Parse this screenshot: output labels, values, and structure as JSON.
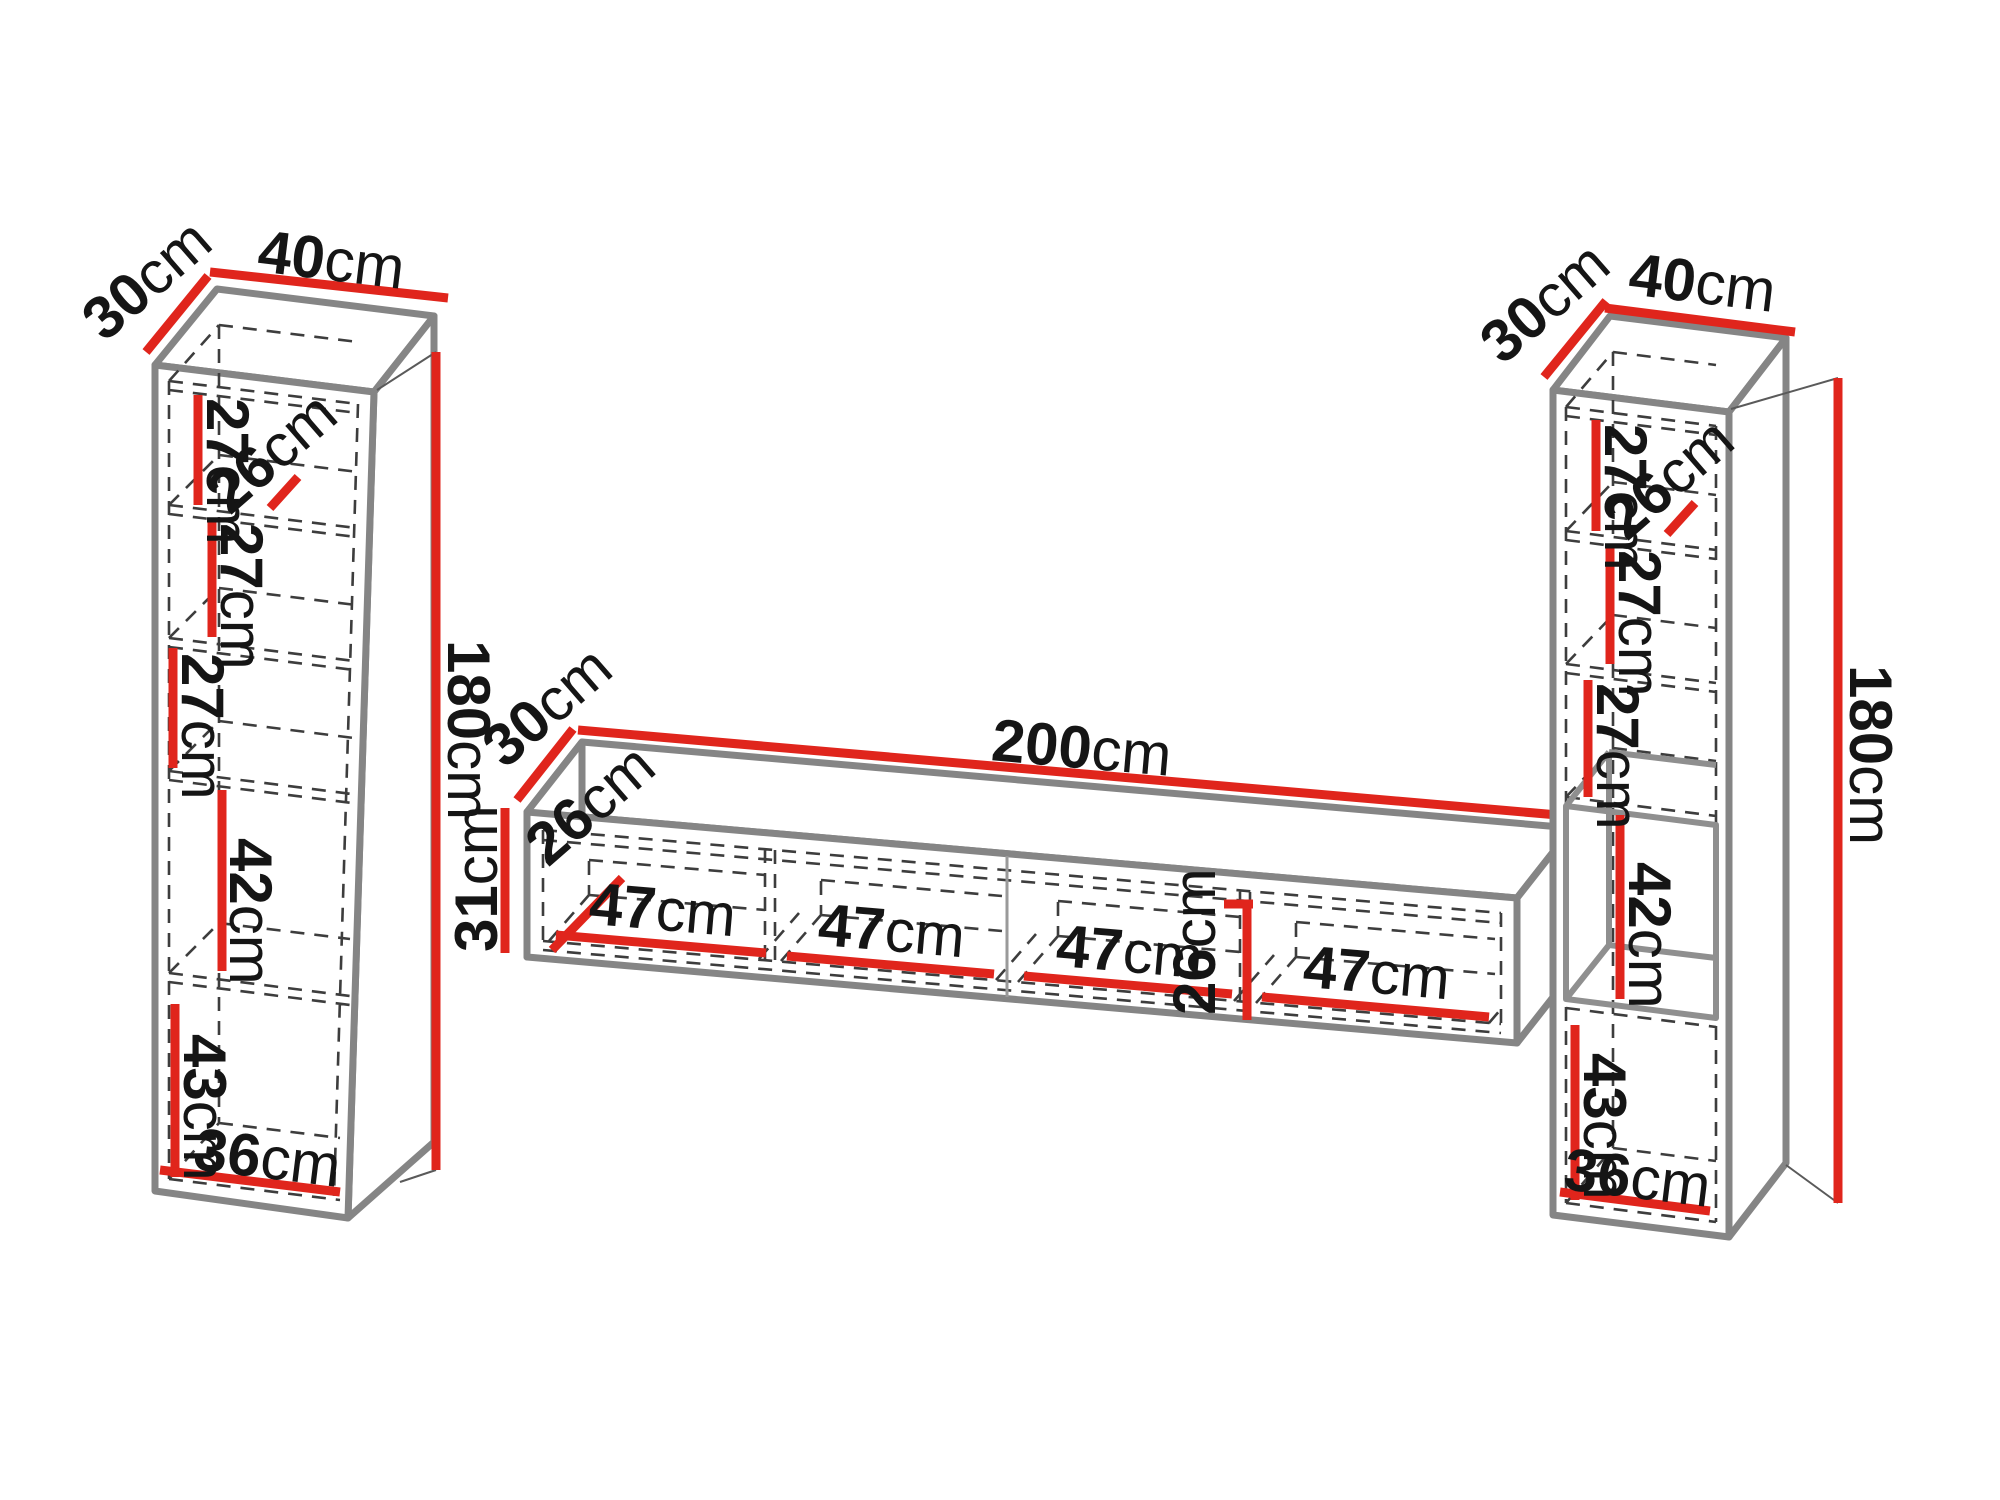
{
  "diagram": {
    "background": "#ffffff",
    "colors": {
      "dimension_line": "#e0251c",
      "edge": "#858585",
      "hidden_line": "#3d3d3d",
      "label_text": "#151515"
    },
    "left_cabinet": {
      "depth": {
        "value": "30",
        "unit": "cm"
      },
      "width": {
        "value": "40",
        "unit": "cm"
      },
      "height": {
        "value": "180",
        "unit": "cm"
      },
      "shelf_1": {
        "value": "27",
        "unit": "cm"
      },
      "inner_depth": {
        "value": "26",
        "unit": "cm"
      },
      "shelf_2": {
        "value": "27",
        "unit": "cm"
      },
      "shelf_3": {
        "value": "27",
        "unit": "cm"
      },
      "niche": {
        "value": "42",
        "unit": "cm"
      },
      "bottom_compartment": {
        "value": "43",
        "unit": "cm"
      },
      "inner_width": {
        "value": "36",
        "unit": "cm"
      }
    },
    "tv_stand": {
      "depth": {
        "value": "30",
        "unit": "cm"
      },
      "width": {
        "value": "200",
        "unit": "cm"
      },
      "height": {
        "value": "31",
        "unit": "cm"
      },
      "inner_depth": {
        "value": "26",
        "unit": "cm"
      },
      "inner_height": {
        "value": "26",
        "unit": "cm"
      },
      "compartments": [
        {
          "value": "47",
          "unit": "cm"
        },
        {
          "value": "47",
          "unit": "cm"
        },
        {
          "value": "47",
          "unit": "cm"
        },
        {
          "value": "47",
          "unit": "cm"
        }
      ]
    },
    "right_cabinet": {
      "depth": {
        "value": "30",
        "unit": "cm"
      },
      "width": {
        "value": "40",
        "unit": "cm"
      },
      "height": {
        "value": "180",
        "unit": "cm"
      },
      "shelf_1": {
        "value": "27",
        "unit": "cm"
      },
      "inner_depth": {
        "value": "26",
        "unit": "cm"
      },
      "shelf_2": {
        "value": "27",
        "unit": "cm"
      },
      "shelf_3": {
        "value": "27",
        "unit": "cm"
      },
      "niche": {
        "value": "42",
        "unit": "cm"
      },
      "bottom_compartment": {
        "value": "43",
        "unit": "cm"
      },
      "inner_width": {
        "value": "36",
        "unit": "cm"
      }
    }
  }
}
